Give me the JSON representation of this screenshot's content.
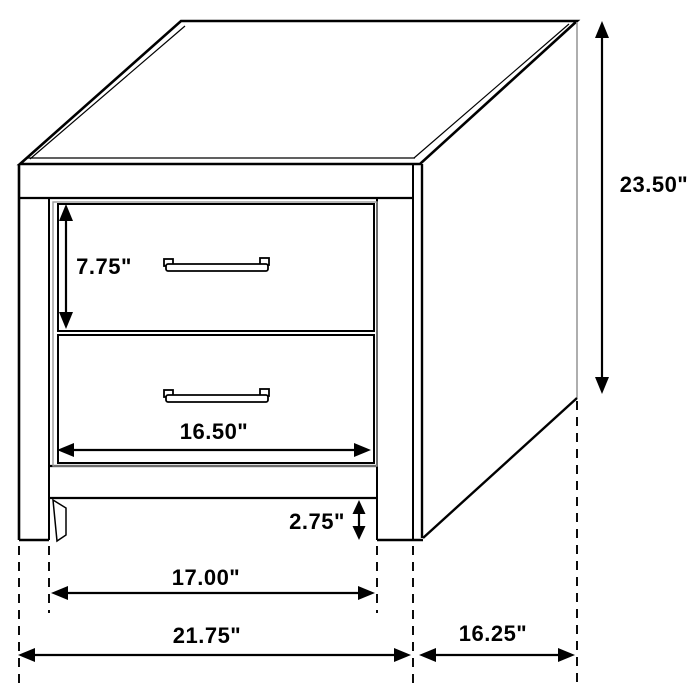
{
  "diagram": {
    "background_color": "#ffffff",
    "line_color": "#000000",
    "detail_line_color": "#9a9a9a"
  },
  "dimensions": {
    "height": {
      "label": "23.50\"",
      "inches": 23.5
    },
    "drawer_height": {
      "label": "7.75\"",
      "inches": 7.75
    },
    "drawer_width": {
      "label": "16.50\"",
      "inches": 16.5
    },
    "clearance": {
      "label": "2.75\"",
      "inches": 2.75
    },
    "inner_width": {
      "label": "17.00\"",
      "inches": 17.0
    },
    "overall_width": {
      "label": "21.75\"",
      "inches": 21.75
    },
    "depth": {
      "label": "16.25\"",
      "inches": 16.25
    }
  }
}
